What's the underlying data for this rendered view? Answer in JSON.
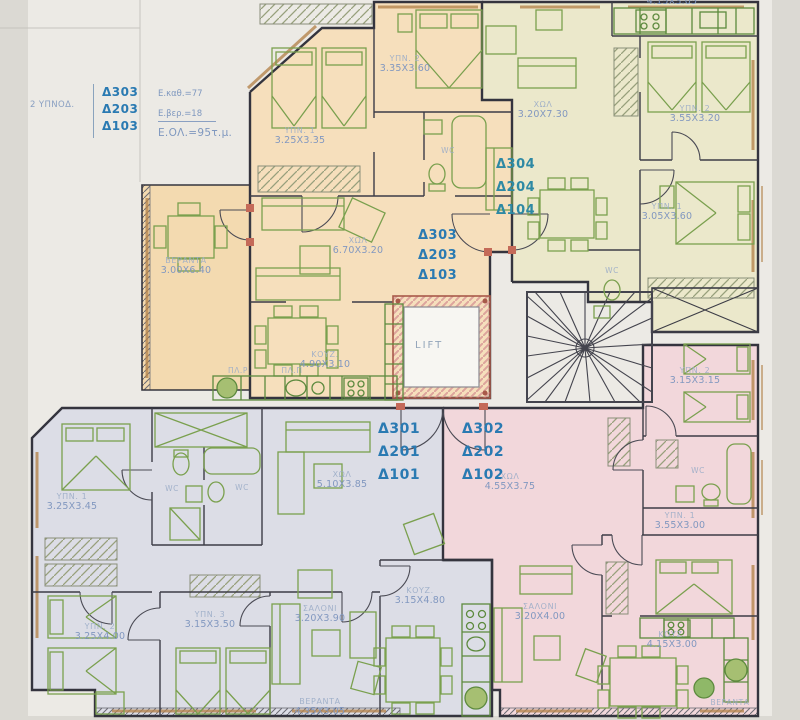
{
  "legend": {
    "type": "2 ΥΠΝΟΔ.",
    "area1": "Ε.καθ.=77",
    "area2": "Ε.βερ.=18",
    "total": "Ε.ΟΛ.=95τ.μ."
  },
  "stacks": {
    "s303a": [
      "Δ303",
      "Δ203",
      "Δ103"
    ],
    "s304": [
      "Δ304",
      "Δ204",
      "Δ104"
    ],
    "s303b": [
      "Δ303",
      "Δ203",
      "Δ103"
    ],
    "s301": [
      "Δ301",
      "Δ201",
      "Δ101"
    ],
    "s302": [
      "Δ302",
      "Δ202",
      "Δ102"
    ]
  },
  "lift_label": "LIFT",
  "rooms": {
    "o_bed2": {
      "name": "ΥΠΝ. 2",
      "dims": "3.35X3.60"
    },
    "o_bed1": {
      "name": "ΥΠΝ. 1",
      "dims": "3.25X3.35"
    },
    "o_wc": {
      "name": "WC"
    },
    "o_hall": {
      "name": "ΧΩΛ",
      "dims": "6.70X3.20"
    },
    "o_veranda": {
      "name": "ΒΕΡΑΝΤΑ",
      "dims": "3.00X6.40"
    },
    "o_kitchen": {
      "name": "ΚΟΥΖ.",
      "dims": "4.90X3.10"
    },
    "o_wm": {
      "name": "ΠΛ.Ρ"
    },
    "o_dw": {
      "name": "ΠΛ.Π"
    },
    "g_kitchen": {
      "dims": "4.15X3.05"
    },
    "g_hall": {
      "name": "ΧΩΛ",
      "dims": "3.20X7.30"
    },
    "g_bed2": {
      "name": "ΥΠΝ. 2",
      "dims": "3.55X3.20"
    },
    "g_bed1": {
      "name": "ΥΠΝ. 1",
      "dims": "3.05X3.60"
    },
    "g_wc": {
      "name": "WC"
    },
    "b_bed1": {
      "name": "ΥΠΝ. 1",
      "dims": "3.25X3.45"
    },
    "b_wc1": {
      "name": "WC"
    },
    "b_wc2": {
      "name": "WC"
    },
    "b_hall": {
      "name": "ΧΩΛ",
      "dims": "5.10X3.85"
    },
    "b_bed2": {
      "name": "ΥΠΝ. 2",
      "dims": "3.25X4.00"
    },
    "b_bed3": {
      "name": "ΥΠΝ. 3",
      "dims": "3.15X3.50"
    },
    "b_salon": {
      "name": "ΣΑΛΟΝΙ",
      "dims": "3.20X3.90"
    },
    "b_kitchen": {
      "name": "ΚΟΥΖ.",
      "dims": "3.15X4.80"
    },
    "b_veranda": {
      "name": "ΒΕΡΑΝΤΑ",
      "dims": "4.35X3.05"
    },
    "p_hall": {
      "name": "ΧΩΛ",
      "dims": "4.55X3.75"
    },
    "p_bed2": {
      "name": "ΥΠΝ. 2",
      "dims": "3.15X3.15"
    },
    "p_wc": {
      "name": "WC"
    },
    "p_bed1": {
      "name": "ΥΠΝ. 1",
      "dims": "3.55X3.00"
    },
    "p_salon": {
      "name": "ΣΑΛΟΝΙ",
      "dims": "3.20X4.00"
    },
    "p_kitchen": {
      "name": "ΚΟΥΖ.",
      "dims": "4.15X3.00"
    },
    "p_veranda": {
      "name": "ΒΕΡΑΝΤΑ"
    }
  },
  "colors": {
    "unit_orange": "#f6dfbc",
    "unit_green": "#ebe8cb",
    "unit_blue": "#dcdde6",
    "unit_pink": "#f2d7db",
    "walls": "#34343e",
    "furniture": "#7aa04e",
    "unit_label_blue": "#2a7ab2",
    "unit_label_teal": "#2e89a4",
    "room_label": "#8298c0",
    "lift_frame": "#a85a4a"
  }
}
